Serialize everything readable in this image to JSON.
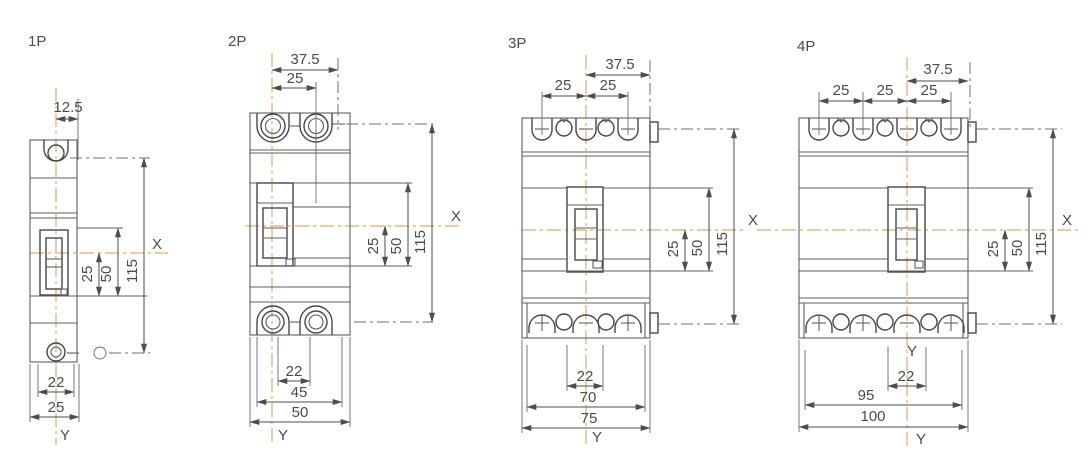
{
  "colors": {
    "background": "#ffffff",
    "drawing_line": "#5f5f5f",
    "dimension_line": "#4d4d4d",
    "text": "#4b4b4b",
    "centerline_orange": "#e9a86b"
  },
  "drawings": [
    {
      "label": "1P",
      "axis_x": "X",
      "axis_y": "Y",
      "dims": {
        "top_offset": "12.5",
        "height_25": "25",
        "height_50": "50",
        "height_115": "115",
        "slot_22": "22",
        "width_25": "25"
      }
    },
    {
      "label": "2P",
      "axis_x": "X",
      "axis_y": "Y",
      "dims": {
        "mount_375": "37.5",
        "pitch_25": "25",
        "height_25": "25",
        "height_50": "50",
        "height_115": "115",
        "slot_22": "22",
        "span_45": "45",
        "width_50": "50"
      }
    },
    {
      "label": "3P",
      "axis_x": "X",
      "axis_y": "Y",
      "dims": {
        "mount_375": "37.5",
        "pitch_25a": "25",
        "pitch_25b": "25",
        "height_25": "25",
        "height_50": "50",
        "height_115": "115",
        "slot_22": "22",
        "span_70": "70",
        "width_75": "75"
      }
    },
    {
      "label": "4P",
      "axis_x": "X",
      "axis_y_mid": "Y",
      "axis_y": "Y",
      "dims": {
        "mount_375": "37.5",
        "pitch_25a": "25",
        "pitch_25b": "25",
        "pitch_25c": "25",
        "height_25": "25",
        "height_50": "50",
        "height_115": "115",
        "slot_22": "22",
        "span_95": "95",
        "width_100": "100"
      }
    }
  ]
}
